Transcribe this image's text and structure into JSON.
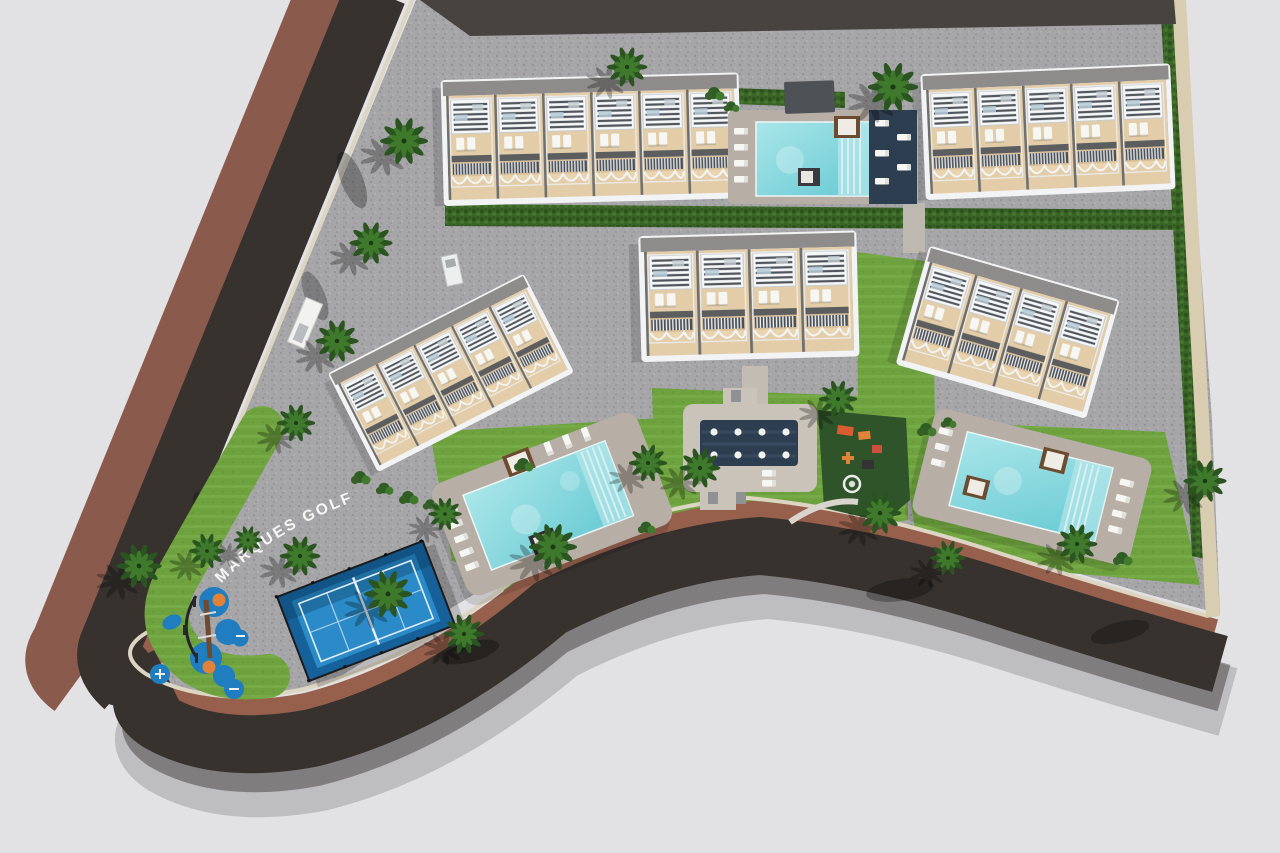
{
  "image": {
    "type": "aerial-3d-site-plan-render",
    "development_name": "MARQUES GOLF",
    "signage_text": "MARQUES GOLF"
  },
  "inventory": {
    "residential_buildings": 5,
    "swimming_pools": 3,
    "padel_courts": 1,
    "playgrounds": 2,
    "community_plazas": 1,
    "roads": 2
  },
  "colors": {
    "background": "#e2e2e4",
    "paving": "#a6a5a7",
    "asphalt": "#37322e",
    "sidewalk_brown": "#8a5a4c",
    "sidewalk_terracotta": "#96604d",
    "curb_cream": "#dcd5c2",
    "lawn": "#6da23f",
    "hedge": "#3a6527",
    "palm": "#2a5420",
    "building_beige": "#e3cda8",
    "building_white": "#f2f3f4",
    "roof_gray": "#8e8c8a",
    "pool_teal": "#7ed4da",
    "deck": "#b7afa5",
    "navy_deck": "#2d3e50",
    "padel_blue": "#2b8bc8",
    "playground_blue": "#1f7dc0",
    "accent_orange": "#e08338",
    "wall_dark": "#474340",
    "text_white": "#f7f7f5"
  }
}
